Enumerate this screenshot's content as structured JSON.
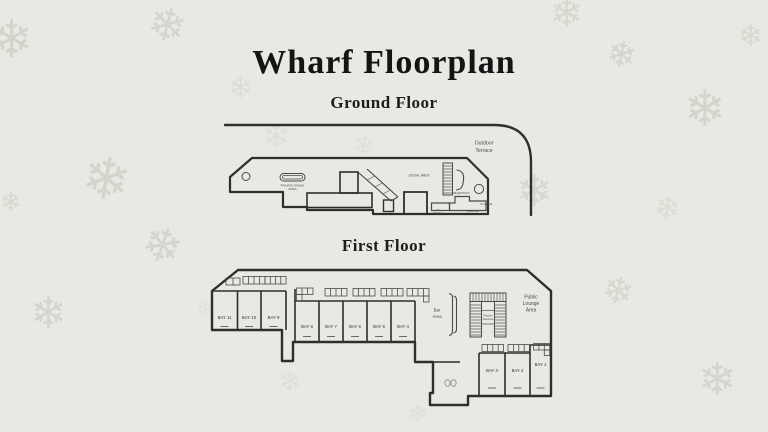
{
  "title": "Wharf Floorplan",
  "ground": {
    "heading": "Ground Floor",
    "terrace": [
      "Outdoor",
      "Terrace"
    ],
    "dining": [
      "PRIVATE DINING",
      "AREA"
    ],
    "social_area": "SOCIAL AREA",
    "reception": "RECEPTION",
    "dj_booth": [
      "DJ",
      "BOOTH"
    ],
    "front_bar": "Front Bar",
    "back_bar": "Back Bar"
  },
  "first": {
    "heading": "First Floor",
    "bays": [
      "BAY 11",
      "BAY 10",
      "BAY 9",
      "BAY 8",
      "BAY 7",
      "BAY 6",
      "BAY 5",
      "BAY 4",
      "BAY 3",
      "BAY 2",
      "BAY 1"
    ],
    "bar_area": [
      "Bar",
      "Area"
    ],
    "feature_staircase": [
      "Feature",
      "Staircase"
    ],
    "public_lounge": [
      "Public",
      "Lounge",
      "Area"
    ]
  },
  "decor": {
    "snowflake": "❄"
  },
  "colors": {
    "background": "#e9e9e3",
    "line": "#2e2e2e",
    "label": "#3d3d3d",
    "snowflake": "#d0d1c9"
  }
}
